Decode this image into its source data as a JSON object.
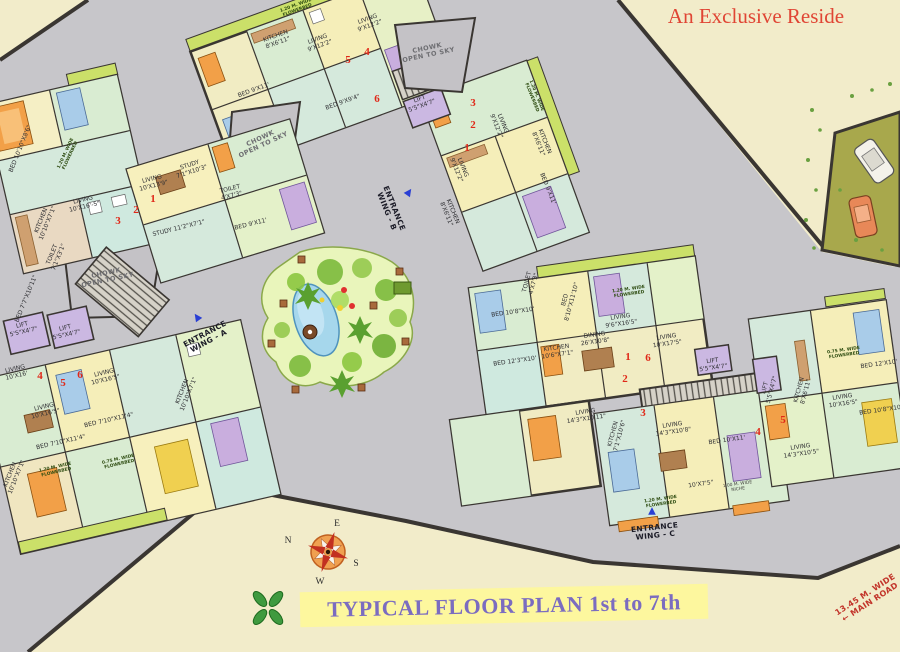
{
  "page": {
    "title_top_right": "An Exclusive Reside",
    "banner_title": "TYPICAL FLOOR PLAN 1st to 7th"
  },
  "compass": {
    "top": "E",
    "left": "N",
    "right": "S",
    "bottom": "W"
  },
  "colors": {
    "background_gray": "#c7c6ca",
    "paper_cream": "#f2ecca",
    "banner_yellow": "#fdf79e",
    "banner_text_purple": "#7b6cc0",
    "title_red": "#e04534",
    "wall_dark": "#3a3632",
    "flowerbed_green": "#cbe069",
    "garden_green": "#e9f5bb",
    "pond_blue": "#a6d7ec",
    "unit_number_red": "#e02818",
    "entrance_arrow_blue": "#2a3fd4",
    "lift_purple": "#cbb8e2"
  },
  "arrows": [
    {
      "x": 197,
      "y": 317,
      "r": -35
    },
    {
      "x": 409,
      "y": 192,
      "r": 35
    },
    {
      "x": 652,
      "y": 511,
      "r": 0
    }
  ],
  "labels": [
    {
      "t": "ENTRANCE\nWING - A",
      "x": 207,
      "y": 338,
      "r": -28,
      "k": "ent"
    },
    {
      "t": "ENTRANCE\nWING - B",
      "x": 390,
      "y": 210,
      "r": 68,
      "k": "ent"
    },
    {
      "t": "ENTRANCE\nWING - C",
      "x": 655,
      "y": 532,
      "r": -6,
      "k": "ent"
    },
    {
      "t": "CHOWK\nOPEN TO SKY",
      "x": 428,
      "y": 52,
      "r": -12,
      "k": "chowk"
    },
    {
      "t": "CHOWK\nOPEN TO SKY",
      "x": 262,
      "y": 142,
      "r": -25,
      "k": "chowk"
    },
    {
      "t": "CHOWK\nOPEN TO SKY",
      "x": 107,
      "y": 277,
      "r": -12,
      "k": "chowk"
    },
    {
      "t": "13.45 M. WIDE\n← MAIN ROAD",
      "x": 868,
      "y": 599,
      "r": -33,
      "k": "road"
    },
    {
      "t": "5",
      "x": 348,
      "y": 60,
      "r": 0,
      "k": "unit"
    },
    {
      "t": "4",
      "x": 367,
      "y": 52,
      "r": 0,
      "k": "unit"
    },
    {
      "t": "6",
      "x": 377,
      "y": 99,
      "r": 0,
      "k": "unit"
    },
    {
      "t": "3",
      "x": 473,
      "y": 103,
      "r": 0,
      "k": "unit"
    },
    {
      "t": "2",
      "x": 473,
      "y": 125,
      "r": 0,
      "k": "unit"
    },
    {
      "t": "1",
      "x": 467,
      "y": 148,
      "r": 0,
      "k": "unit"
    },
    {
      "t": "1",
      "x": 153,
      "y": 199,
      "r": 0,
      "k": "unit"
    },
    {
      "t": "2",
      "x": 136,
      "y": 210,
      "r": 0,
      "k": "unit"
    },
    {
      "t": "3",
      "x": 118,
      "y": 221,
      "r": 0,
      "k": "unit"
    },
    {
      "t": "4",
      "x": 40,
      "y": 376,
      "r": 0,
      "k": "unit"
    },
    {
      "t": "5",
      "x": 63,
      "y": 383,
      "r": 0,
      "k": "unit"
    },
    {
      "t": "6",
      "x": 80,
      "y": 375,
      "r": 0,
      "k": "unit"
    },
    {
      "t": "1",
      "x": 628,
      "y": 357,
      "r": 0,
      "k": "unit"
    },
    {
      "t": "6",
      "x": 648,
      "y": 358,
      "r": 0,
      "k": "unit"
    },
    {
      "t": "2",
      "x": 625,
      "y": 379,
      "r": 0,
      "k": "unit"
    },
    {
      "t": "3",
      "x": 643,
      "y": 413,
      "r": 0,
      "k": "unit"
    },
    {
      "t": "4",
      "x": 758,
      "y": 432,
      "r": 0,
      "k": "unit"
    },
    {
      "t": "5",
      "x": 783,
      "y": 420,
      "r": 0,
      "k": "unit"
    },
    {
      "t": "KITCHEN\n8'X6'11\"",
      "x": 277,
      "y": 40,
      "r": -20,
      "k": "room"
    },
    {
      "t": "LIVING\n9'X12'2\"",
      "x": 319,
      "y": 43,
      "r": -20,
      "k": "room"
    },
    {
      "t": "LIVING\n9'X12'2\"",
      "x": 369,
      "y": 23,
      "r": -20,
      "k": "room"
    },
    {
      "t": "BED 9'X11'",
      "x": 254,
      "y": 91,
      "r": -20,
      "k": "room"
    },
    {
      "t": "BED 9'X9'4\"",
      "x": 343,
      "y": 103,
      "r": -20,
      "k": "room"
    },
    {
      "t": "LIFT\n5'5\"X4'7\"",
      "x": 421,
      "y": 103,
      "r": -20,
      "k": "room"
    },
    {
      "t": "BED 10'10\"X8'6\"",
      "x": 21,
      "y": 149,
      "r": -68,
      "k": "room"
    },
    {
      "t": "LIVING\n10'X16'-5\"",
      "x": 84,
      "y": 204,
      "r": -13,
      "k": "room"
    },
    {
      "t": "KITCHEN\n10'10\"X7'1\"",
      "x": 45,
      "y": 222,
      "r": -68,
      "k": "room"
    },
    {
      "t": "TOILET\n7'1\"X3'1\"",
      "x": 56,
      "y": 256,
      "r": -68,
      "k": "room"
    },
    {
      "t": "STUDY\n7'1\"X10'3\"",
      "x": 191,
      "y": 169,
      "r": -18,
      "k": "room"
    },
    {
      "t": "LIVING\n10'X13'9\"",
      "x": 153,
      "y": 183,
      "r": -14,
      "k": "room"
    },
    {
      "t": "STUDY 11'2\"X7'1\"",
      "x": 179,
      "y": 229,
      "r": -14,
      "k": "room"
    },
    {
      "t": "TOILET\n4'X7'3\"",
      "x": 231,
      "y": 193,
      "r": -14,
      "k": "room"
    },
    {
      "t": "BED 9'X11'",
      "x": 251,
      "y": 225,
      "r": -14,
      "k": "room"
    },
    {
      "t": "BED 7'7\"X10'11\"",
      "x": 27,
      "y": 299,
      "r": -68,
      "k": "room"
    },
    {
      "t": "LIFT\n5'5\"X4'7\"",
      "x": 23,
      "y": 329,
      "r": -13,
      "k": "room"
    },
    {
      "t": "LIFT\n5'5\"X4'7\"",
      "x": 66,
      "y": 332,
      "r": -13,
      "k": "room"
    },
    {
      "t": "LIVING\n10'X16'",
      "x": 16,
      "y": 373,
      "r": -13,
      "k": "room"
    },
    {
      "t": "LIVING\n10'X16'5\"",
      "x": 105,
      "y": 377,
      "r": -13,
      "k": "room"
    },
    {
      "t": "LIVING\n10'X16'5\"",
      "x": 45,
      "y": 411,
      "r": -13,
      "k": "room"
    },
    {
      "t": "BED 7'10\"X11'4\"",
      "x": 109,
      "y": 421,
      "r": -13,
      "k": "room"
    },
    {
      "t": "BED 7'10\"X11'4\"",
      "x": 61,
      "y": 443,
      "r": -13,
      "k": "room"
    },
    {
      "t": "KITCHEN\n10'10\"X7'1\"",
      "x": 14,
      "y": 476,
      "r": -68,
      "k": "room"
    },
    {
      "t": "KITCHEN\n10'10\"X7'1\"",
      "x": 186,
      "y": 393,
      "r": -68,
      "k": "room"
    },
    {
      "t": "LIVING\n9'X12'2\"",
      "x": 459,
      "y": 169,
      "r": 68,
      "k": "room"
    },
    {
      "t": "LIVING\n9'X12'2\"",
      "x": 499,
      "y": 125,
      "r": 68,
      "k": "room"
    },
    {
      "t": "KITCHEN\n8'X6'11\"",
      "x": 541,
      "y": 143,
      "r": 68,
      "k": "room"
    },
    {
      "t": "BED 9'X11'",
      "x": 547,
      "y": 189,
      "r": 68,
      "k": "room"
    },
    {
      "t": "KITCHEN\n8'X6'11\"",
      "x": 449,
      "y": 213,
      "r": 68,
      "k": "room"
    },
    {
      "t": "BED 10'8\"X10'",
      "x": 513,
      "y": 313,
      "r": -8,
      "k": "room"
    },
    {
      "t": "BED\n8'10\"X11'10\"",
      "x": 569,
      "y": 301,
      "r": -75,
      "k": "room"
    },
    {
      "t": "LIVING\n9'6\"X16'5\"",
      "x": 621,
      "y": 321,
      "r": -8,
      "k": "room"
    },
    {
      "t": "DINING\n26'X10'8\"",
      "x": 595,
      "y": 339,
      "r": -8,
      "k": "room"
    },
    {
      "t": "KITCHEN\n10'6\"X7'1\"",
      "x": 557,
      "y": 352,
      "r": -8,
      "k": "room"
    },
    {
      "t": "BED 12'3\"X10'",
      "x": 515,
      "y": 362,
      "r": -8,
      "k": "room"
    },
    {
      "t": "TOILET\n4'X7'3\"",
      "x": 531,
      "y": 283,
      "r": -75,
      "k": "room"
    },
    {
      "t": "LIVING\n10'X17'5\"",
      "x": 667,
      "y": 341,
      "r": -8,
      "k": "room"
    },
    {
      "t": "LIVING\n14'3\"X10'11\"",
      "x": 586,
      "y": 416,
      "r": -8,
      "k": "room"
    },
    {
      "t": "KITCHEN\n7'1\"X10'6\"",
      "x": 617,
      "y": 435,
      "r": -75,
      "k": "room"
    },
    {
      "t": "LIVING\n14'3\"X10'8\"",
      "x": 673,
      "y": 429,
      "r": -8,
      "k": "room"
    },
    {
      "t": "BED 10'X11'",
      "x": 727,
      "y": 441,
      "r": -8,
      "k": "room"
    },
    {
      "t": "LIFT\n5'5\"X4'7\"",
      "x": 713,
      "y": 365,
      "r": -8,
      "k": "room"
    },
    {
      "t": "LIFT\n5'5\"X4'7\"",
      "x": 769,
      "y": 389,
      "r": -75,
      "k": "room"
    },
    {
      "t": "KITCHEN\n8'X6'11\"",
      "x": 803,
      "y": 391,
      "r": -75,
      "k": "room"
    },
    {
      "t": "LIVING\n10'X16'5\"",
      "x": 843,
      "y": 401,
      "r": -8,
      "k": "room"
    },
    {
      "t": "LIVING\n14'3\"X10'5\"",
      "x": 801,
      "y": 451,
      "r": -8,
      "k": "room"
    },
    {
      "t": "BED 12'X10'",
      "x": 879,
      "y": 365,
      "r": -8,
      "k": "room"
    },
    {
      "t": "BED 10'8\"X10'",
      "x": 881,
      "y": 411,
      "r": -8,
      "k": "room"
    },
    {
      "t": "10'X7'5\"",
      "x": 701,
      "y": 485,
      "r": -8,
      "k": "room"
    },
    {
      "t": "1.20 M. WIDE\nFLOWERBED",
      "x": 297,
      "y": 9,
      "r": -20,
      "k": "fb"
    },
    {
      "t": "1.20 M. WIDE\nFLOWERBED",
      "x": 69,
      "y": 155,
      "r": -65,
      "k": "fb"
    },
    {
      "t": "1.20 M. WIDE\nFLOWERBED",
      "x": 533,
      "y": 97,
      "r": 68,
      "k": "fb"
    },
    {
      "t": "1.20 M. WIDE\nFLOWERBED",
      "x": 629,
      "y": 293,
      "r": -8,
      "k": "fb"
    },
    {
      "t": "1.20 M. WIDE\nFLOWERBED",
      "x": 661,
      "y": 503,
      "r": -8,
      "k": "fb"
    },
    {
      "t": "0.75 M. WIDE\nFLOWERBED",
      "x": 844,
      "y": 354,
      "r": -8,
      "k": "fb"
    },
    {
      "t": "1.20 M. WIDE\nFLOWERBED",
      "x": 56,
      "y": 471,
      "r": -13,
      "k": "fb"
    },
    {
      "t": "0.75 M. WIDE\nFLOWERBED",
      "x": 119,
      "y": 463,
      "r": -13,
      "k": "fb"
    },
    {
      "t": "1.00 M. WIDE\nNICHE",
      "x": 738,
      "y": 488,
      "r": -8,
      "k": "niche"
    }
  ]
}
